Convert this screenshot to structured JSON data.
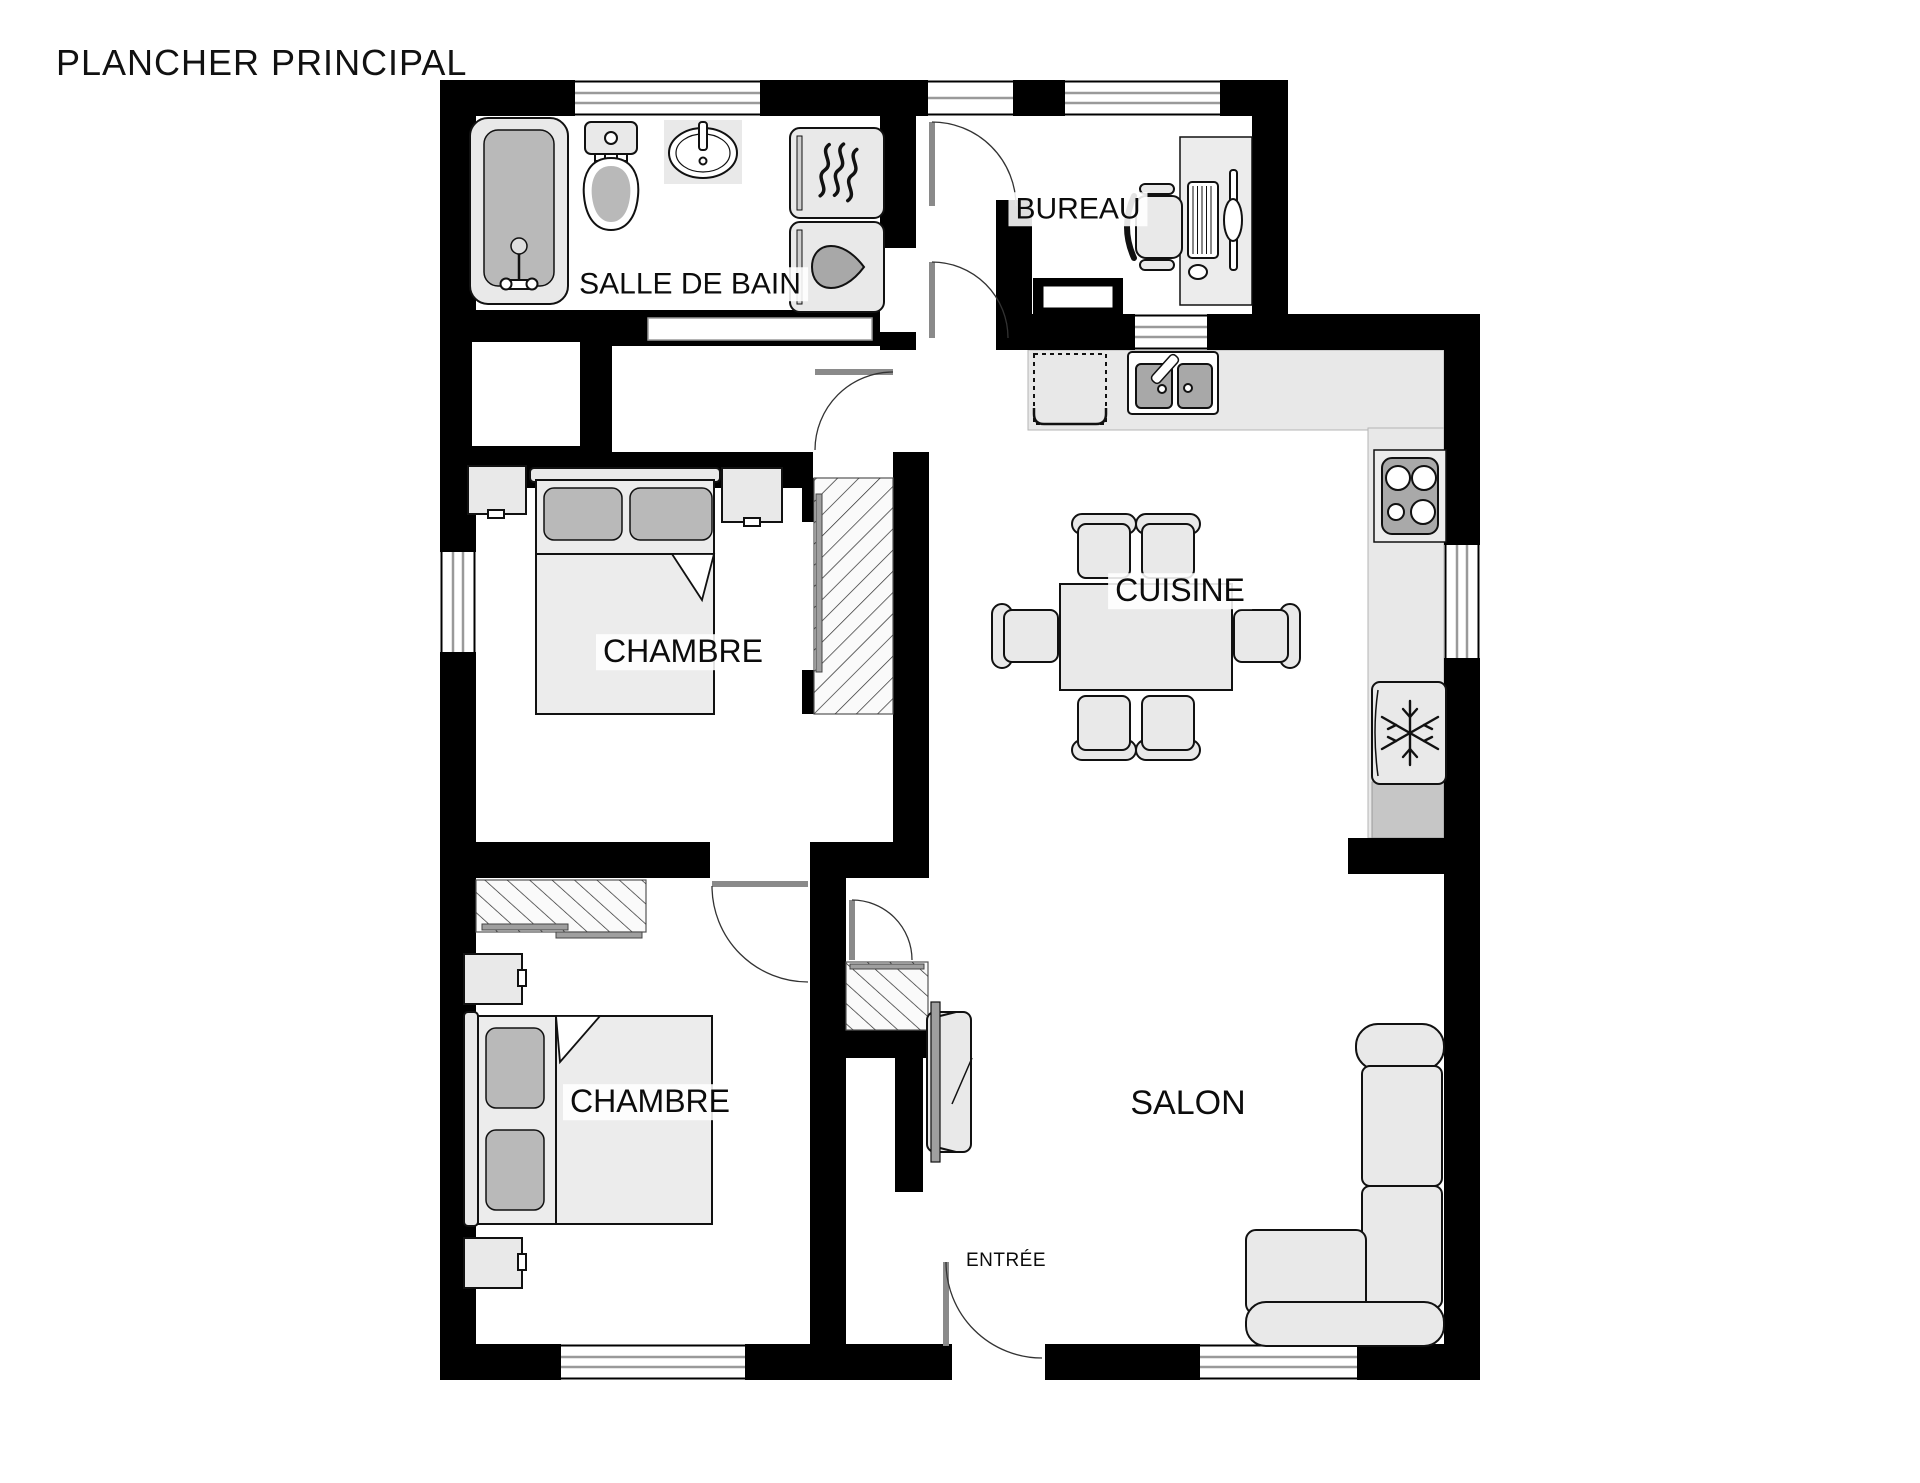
{
  "title": "PLANCHER PRINCIPAL",
  "rooms": {
    "bathroom": {
      "label": "SALLE DE BAIN"
    },
    "office": {
      "label": "BUREAU"
    },
    "kitchen": {
      "label": "CUISINE"
    },
    "bedroom_top": {
      "label": "CHAMBRE"
    },
    "bedroom_bottom": {
      "label": "CHAMBRE"
    },
    "living_room": {
      "label": "SALON"
    },
    "entry": {
      "label": "ENTRÉE"
    }
  },
  "icons": {
    "dryer": "heat-waves-icon",
    "washer": "water-drop-icon",
    "fridge": "snowflake-icon",
    "stove": "four-burners-icon",
    "closets": "hatched-area",
    "doors": "quarter-arc-swing"
  },
  "colors": {
    "wall": "#000000",
    "furniture_fill": "#e9e9e9",
    "furniture_dark": "#b9b9b9",
    "counter": "#e8e8e8",
    "cabinet_dark": "#c6c6c6",
    "door_leaf": "#8a8a8a",
    "window_line": "#9a9a9a",
    "label_text": "#0c0c0c"
  }
}
